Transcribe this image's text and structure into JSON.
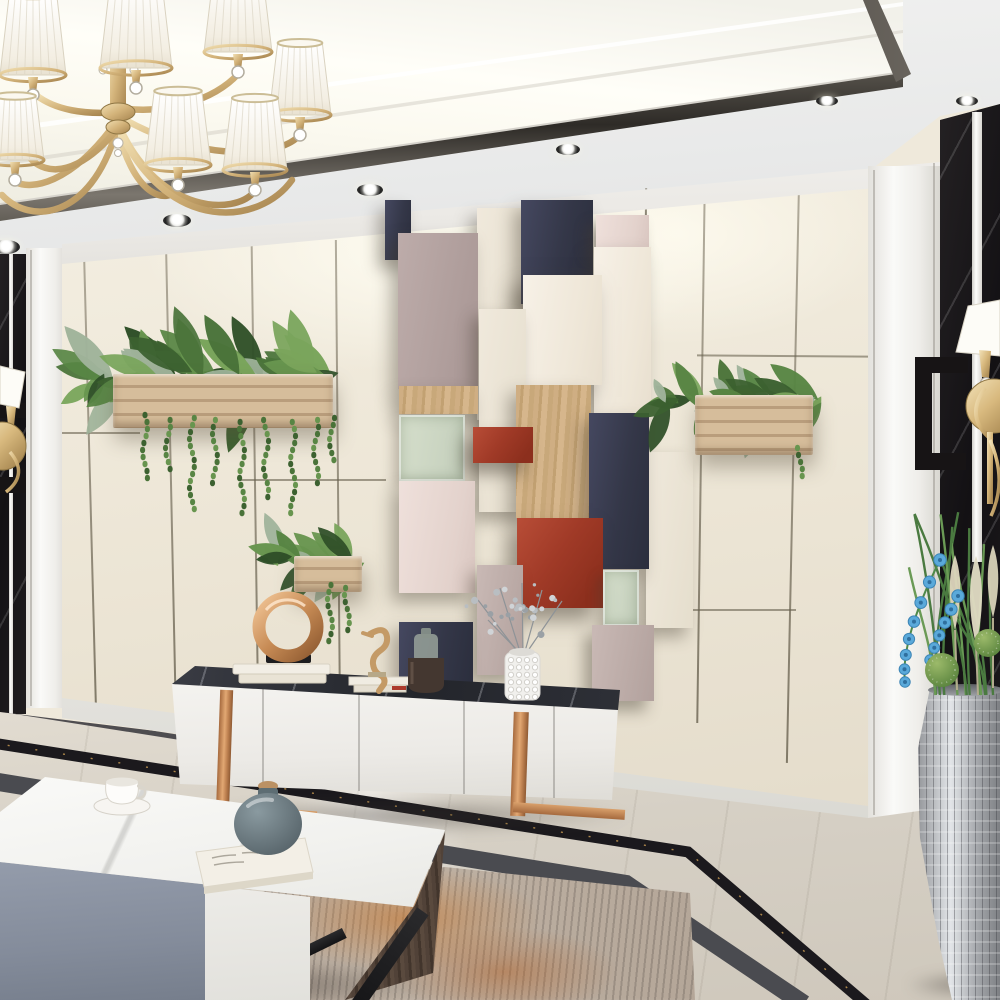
{
  "meta": {
    "title": "Modern living room interior",
    "description": "3D render of a modern living room with a gold chandelier, geometric 3D feature wall panels, wall planters, a white TV console with copper legs, a marble coffee table, marble floor with black border inlay and an abstract rug"
  },
  "palette": {
    "ceiling": "#eceded",
    "cove_light": "#fdfcf4",
    "metal_trim": "#3a3733",
    "wall_cream": "#efe8da",
    "panel_seam": "#6f6752",
    "marble_black": "#171417",
    "gold": "#d4b57e",
    "planter_wood": "#c9ae8b",
    "foliage_green": "#4c7a3f",
    "block_navy": "#383b4a",
    "block_blush": "#e9dad4",
    "block_mauve": "#b7a6a3",
    "block_red": "#a03c2b",
    "block_wood": "#c9a87c",
    "block_glass": "#ccd5c3",
    "tv_stand_white": "#f3f2ef",
    "tv_top_marble": "#2a2c32",
    "copper": "#c98f5f",
    "floor_marble": "#d8d2c7",
    "floor_border_black": "#1b191d",
    "floor_border_gray": "#4a4b50",
    "rug_gray": "#ad9f92",
    "rug_orange": "#c07a3c",
    "table_gray": "#8b93a2",
    "table_white": "#e9e8e4",
    "table_wood_dark": "#4b3d33",
    "vase_teal": "#5f7076",
    "orchid_blue": "#57a8dc",
    "vase_silver": "#c0c3c6"
  },
  "objects": {
    "scene": "Modern living room interior render",
    "chandelier": "Gold chandelier with white pleated shades and crystals",
    "spotlight": "Recessed ceiling spotlight",
    "feature_wall": "Geometric 3D block feature wall in navy, cream, mauve, red and wood",
    "planter_large": "Long wooden wall planter with trailing greenery",
    "planter_small": "Small wooden wall planter with trailing greenery",
    "planter_right": "Wooden wall planter with green plants",
    "sconce_left": "Gold wall sconce with white shade",
    "sconce_right": "Gold wall sconce with white shade",
    "tv_console": "White TV console with dark marble top and copper legs",
    "ring_sculpture": "Copper ring sculpture on books",
    "seahorse": "Carved seahorse figurine",
    "bottle": "Dark glass decorative bottle",
    "white_vase": "White sculpted vase with silver-grey flower spray",
    "coffee_table": "Marble-top coffee table with grey, white and dark wood sides",
    "tea_cup": "White tea cup and saucer",
    "table_vase": "Teal-grey round vase with wooden stopper on a book",
    "rug": "Abstract grey and rust-orange area rug",
    "floor_border": "Black marble floor border inlay",
    "silver_vase": "Tall silver mosaic floor vase with blue orchids, grasses and pampas"
  }
}
